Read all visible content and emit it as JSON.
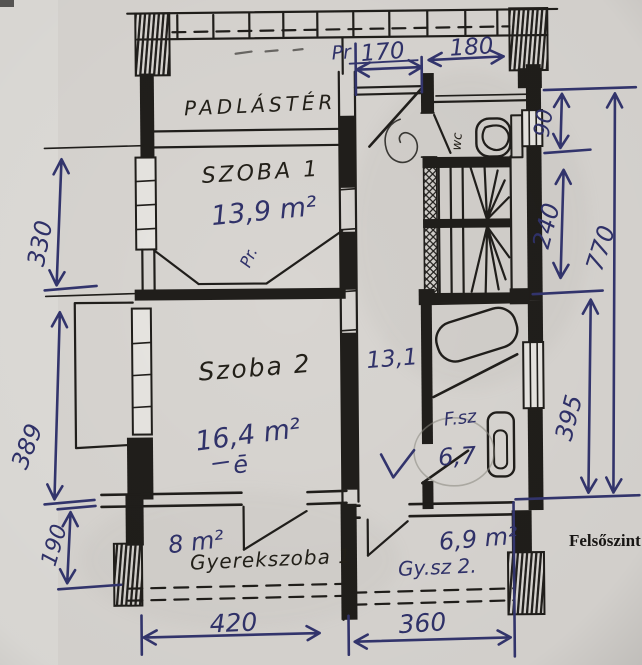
{
  "meta": {
    "floor_label": "Felsőszint"
  },
  "rooms": {
    "attic": {
      "name": "PADLÁSTÉR"
    },
    "room1": {
      "name": "SZOBA 1",
      "area": "13,9 m²",
      "note": "Pr."
    },
    "room2": {
      "name": "Szoba 2",
      "area": "16,4 m²",
      "note": "ē"
    },
    "hall": {
      "area": "13,1"
    },
    "wc": {
      "name": "wc"
    },
    "bathroom": {
      "name": "F.sz",
      "area": "6,7"
    },
    "kidsroom1": {
      "name": "Gyerekszoba 1",
      "area": "8 m²"
    },
    "kidsroom2": {
      "name": "Gy.sz 2.",
      "area": "6,9 m²"
    }
  },
  "dimensions_cm": {
    "top_note": "Pr",
    "top_hall": "170",
    "top_wc": "180",
    "right_wc": "90",
    "right_stairs": "240",
    "right_total": "770",
    "right_bath": "395",
    "left_room1": "330",
    "left_room2": "389",
    "left_kids": "190",
    "bottom_left": "420",
    "bottom_right": "360"
  },
  "colors": {
    "paper": "#d8d5d1",
    "ink": "#201e1b",
    "pen": "#33356e"
  }
}
